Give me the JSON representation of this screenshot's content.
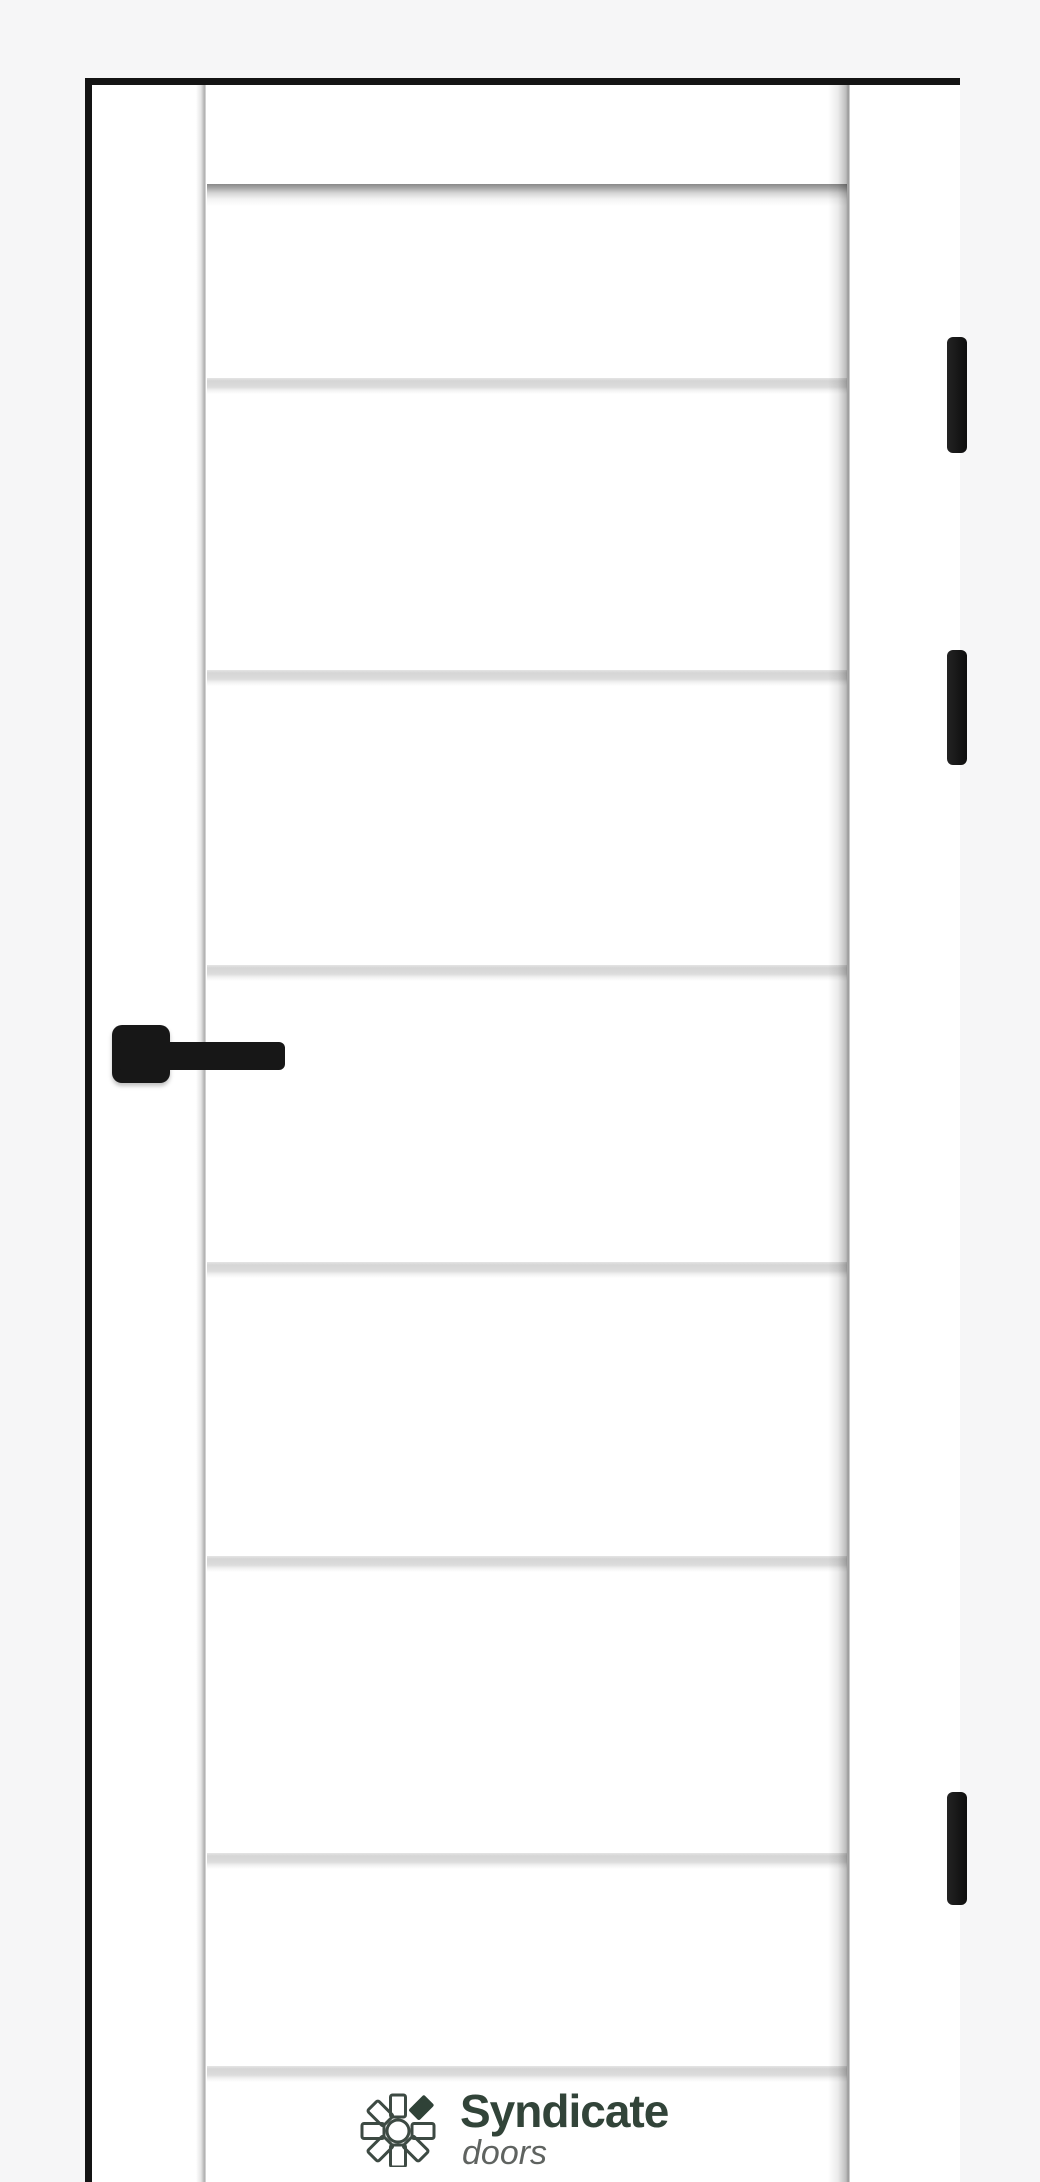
{
  "scene": {
    "description": "White interior door leaf with eight horizontal grooves, black square handle on the left, three black hinges on the right jamb, thin black frame outline on light gray background",
    "background_color": "#f6f6f7",
    "door_color": "#ffffff",
    "outline_color": "#141414",
    "handle_color": "#171717",
    "groove_count": 8,
    "grooves_y": [
      184,
      378,
      670,
      965,
      1262,
      1556,
      1853,
      2066
    ],
    "hinge_count": 3,
    "hinges": [
      {
        "y": 337,
        "h": 116
      },
      {
        "y": 650,
        "h": 115
      },
      {
        "y": 1792,
        "h": 113
      }
    ]
  },
  "brand": {
    "name": "Syndicate",
    "tagline": "doors",
    "icon": "pinwheel-icon",
    "name_color": "#324439",
    "tagline_color": "#5f6360"
  }
}
